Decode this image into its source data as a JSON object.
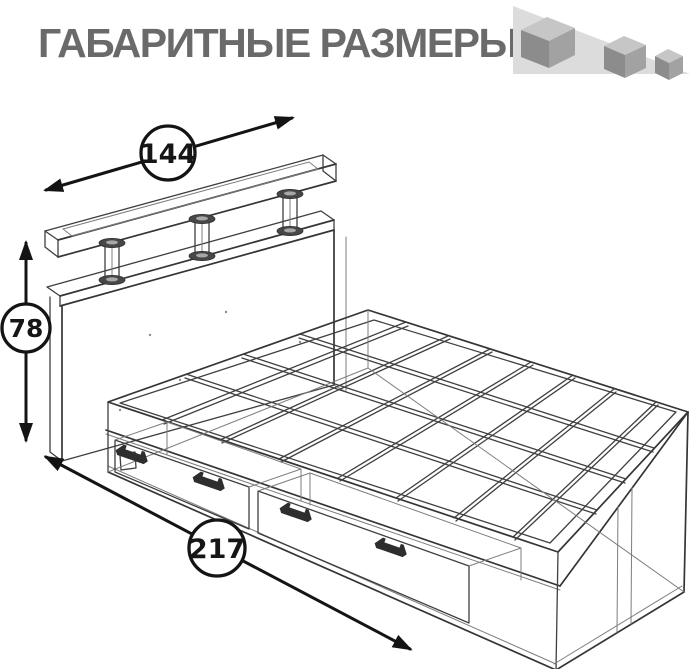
{
  "title": "ГАБАРИТНЫЕ РАЗМЕРЫ",
  "dimensions": {
    "width": "144",
    "height": "78",
    "length": "217"
  },
  "logo": {
    "icon": "three-shrinking-cubes-on-slope",
    "cube_count": 3,
    "slope_color": "#dcdcdc",
    "cube_top_color": "#c6c6c6",
    "cube_left_color": "#8c8c8c",
    "cube_right_color": "#a2a2a2"
  },
  "figure": {
    "subject": "bed-wireframe-drawing"
  },
  "colors": {
    "title_text": "#6a6a6a",
    "drawing_line": "#3f3f3f",
    "dimension_line": "#141414"
  }
}
